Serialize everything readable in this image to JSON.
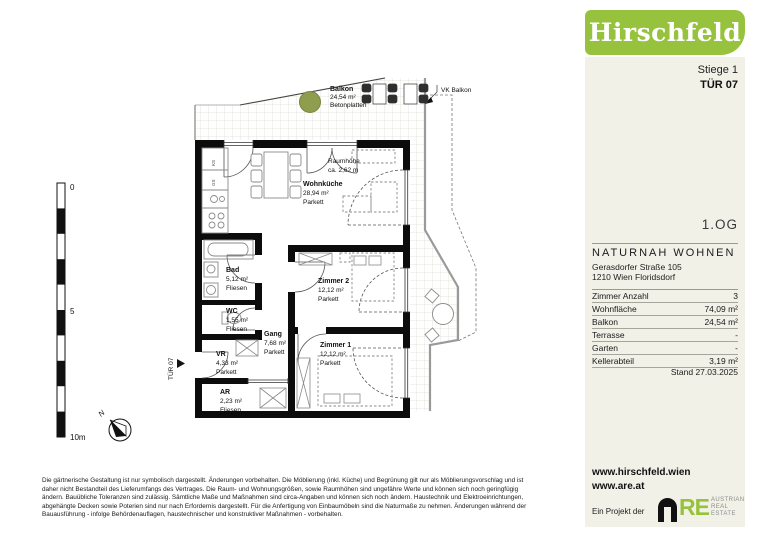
{
  "sidebar": {
    "brand": "Hirschfeld",
    "stiege": "Stiege 1",
    "tuer": "TÜR 07",
    "compass_n": "N",
    "floor_label": "1.OG",
    "project_name": "NATURNAH WOHNEN",
    "address_line1": "Gerasdorfer Straße 105",
    "address_line2": "1210 Wien Floridsdorf",
    "facts": [
      {
        "label": "Zimmer Anzahl",
        "value": "3"
      },
      {
        "label": "Wohnfläche",
        "value": "74,09 m²"
      },
      {
        "label": "Balkon",
        "value": "24,54 m²"
      },
      {
        "label": "Terrasse",
        "value": "-"
      },
      {
        "label": "Garten",
        "value": "-"
      },
      {
        "label": "Kellerabteil",
        "value": "3,19 m²"
      }
    ],
    "stand": "Stand 27.03.2025",
    "website1": "www.hirschfeld.wien",
    "website2": "www.are.at",
    "project_note": "Ein Projekt der",
    "are_logo": {
      "re": "RE",
      "line1": "AUSTRIAN",
      "line2": "REAL",
      "line3": "ESTATE"
    }
  },
  "plan": {
    "compass_n": "N",
    "entrance_label": "TÜR 07",
    "scale": {
      "top": "0",
      "mid": "5",
      "bottom": "10m"
    },
    "vk_balkon": "VK Balkon",
    "raumhoehe_line1": "Raumhöhe",
    "raumhoehe_line2": "ca. 2,62 m",
    "balkon": {
      "name": "Balkon",
      "area": "24,54 m²",
      "floor": "Betonplatten"
    },
    "rooms": {
      "wohnkueche": {
        "name": "Wohnküche",
        "area": "28,94 m²",
        "floor": "Parkett"
      },
      "bad": {
        "name": "Bad",
        "area": "5,12 m²",
        "floor": "Fliesen"
      },
      "wc": {
        "name": "WC",
        "area": "1,55 m²",
        "floor": "Fliesen"
      },
      "zimmer2": {
        "name": "Zimmer 2",
        "area": "12,12 m²",
        "floor": "Parkett"
      },
      "zimmer1": {
        "name": "Zimmer 1",
        "area": "12,12 m²",
        "floor": "Parkett"
      },
      "gang": {
        "name": "Gang",
        "area": "7,68 m²",
        "floor": "Parkett"
      },
      "vr": {
        "name": "VR",
        "area": "4,33 m²",
        "floor": "Parkett"
      },
      "ar": {
        "name": "AR",
        "area": "2,23 m²",
        "floor": "Fliesen"
      }
    },
    "kitchen_labels": {
      "ks": "KS",
      "gs": "GS"
    }
  },
  "disclaimer": {
    "line1": "Die gärtnerische Gestaltung ist nur symbolisch dargestellt. Änderungen vorbehalten. Die Möblierung (inkl. Küche) und Begrünung gilt nur als Möblierungsvorschlag und ist",
    "line2": "daher nicht Bestandteil des Lieferumfangs des Vertrages. Die Raum- und Wohnungsgrößen, sowie Raumhöhen sind ungefähre Werte und können sich noch geringfügig",
    "line3": "ändern. Bauübliche Toleranzen sind zulässig. Sämtliche Maße und Maßnahmen sind circa-Angaben und können sich noch ändern. Haustechnik und Elektroeinrichtungen,",
    "line4": "abgehängte Decken sowie Poterien sind nur nach Erfordernis dargestellt. Für die Anfertigung von Einbaumöbeln sind die Naturmaße zu nehmen. Änderungen während der",
    "line5": "Bauausführung - infolge Behördenauflagen, haustechnischer und konstruktiver Maßnahmen - vorbehalten."
  }
}
